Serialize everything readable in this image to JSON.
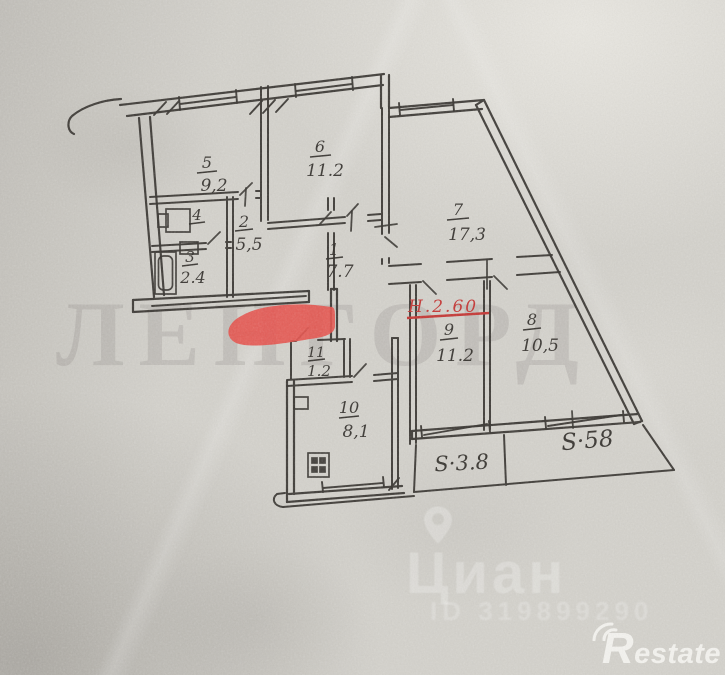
{
  "plan": {
    "height_note": "Н.2.60",
    "rooms": [
      {
        "num": "5",
        "area": "9,2"
      },
      {
        "num": "6",
        "area": "11.2"
      },
      {
        "num": "7",
        "area": "17,3"
      },
      {
        "num": "4",
        "area": ""
      },
      {
        "num": "3",
        "area": "2.4"
      },
      {
        "num": "2",
        "area": "5,5"
      },
      {
        "num": "1",
        "area": "7.7"
      },
      {
        "num": "11",
        "area": "1.2"
      },
      {
        "num": "9",
        "area": "11.2"
      },
      {
        "num": "8",
        "area": "10,5"
      },
      {
        "num": "10",
        "area": "8,1"
      }
    ],
    "balconies": [
      {
        "label": "S·3.8"
      },
      {
        "label": "S·58"
      }
    ]
  },
  "watermarks": {
    "agency": "ЛЕНГОРД",
    "portal": "Циан",
    "listing_id": "ID 319899290",
    "corner_logo": "Restate"
  }
}
